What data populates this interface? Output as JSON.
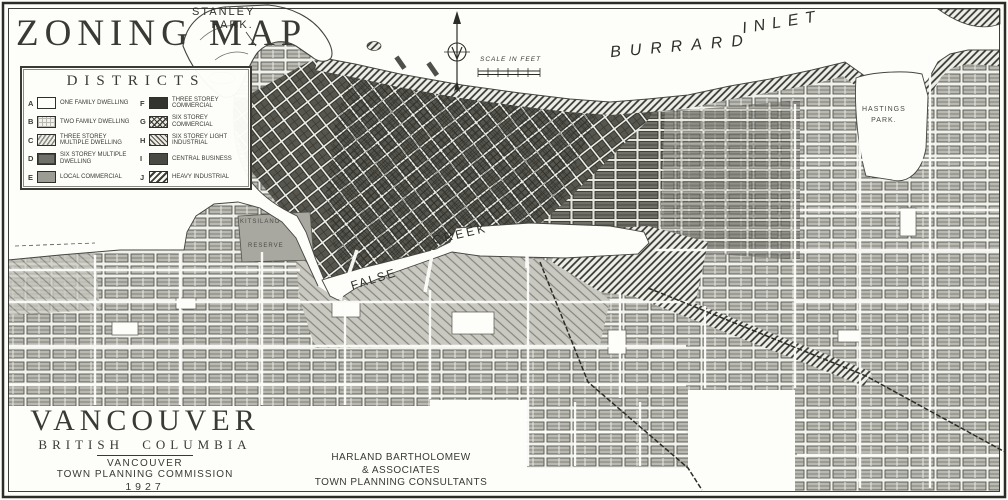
{
  "map": {
    "title": "ZONING MAP",
    "labels": {
      "stanley_park_line1": "STANLEY",
      "stanley_park_line2": "PARK.",
      "burrard": "BURRARD",
      "inlet": "INLET",
      "scale_caption": "SCALE IN FEET",
      "hastings_line1": "HASTINGS",
      "hastings_line2": "PARK.",
      "false_creek_line1": "FALSE",
      "false_creek_line2": "CREEK",
      "kitsilano_line1": "KITSILANO",
      "kitsilano_line2": "RESERVE"
    }
  },
  "legend": {
    "title": "DISTRICTS",
    "items": [
      {
        "key": "A",
        "label": "ONE FAMILY DWELLING"
      },
      {
        "key": "B",
        "label": "TWO FAMILY DWELLING"
      },
      {
        "key": "C",
        "label": "THREE STOREY MULTIPLE DWELLING"
      },
      {
        "key": "D",
        "label": "SIX STOREY MULTIPLE DWELLING"
      },
      {
        "key": "E",
        "label": "LOCAL COMMERCIAL"
      },
      {
        "key": "F",
        "label": "THREE STOREY COMMERCIAL"
      },
      {
        "key": "G",
        "label": "SIX STOREY COMMERCIAL"
      },
      {
        "key": "H",
        "label": "SIX STOREY LIGHT INDUSTRIAL"
      },
      {
        "key": "I",
        "label": "CENTRAL BUSINESS"
      },
      {
        "key": "J",
        "label": "HEAVY INDUSTRIAL"
      }
    ]
  },
  "credits": {
    "city": "VANCOUVER",
    "province": "BRITISH COLUMBIA",
    "org_line1": "VANCOUVER",
    "org_line2": "TOWN PLANNING COMMISSION",
    "year": "1927",
    "consultant_line1": "HARLAND BARTHOLOMEW",
    "consultant_line2": "& ASSOCIATES",
    "consultant_line3": "TOWN PLANNING CONSULTANTS"
  },
  "colors": {
    "ink": "#2b2b27",
    "paper": "#fdfdfa",
    "midgray": "#9c9c94",
    "dark": "#34342f"
  }
}
